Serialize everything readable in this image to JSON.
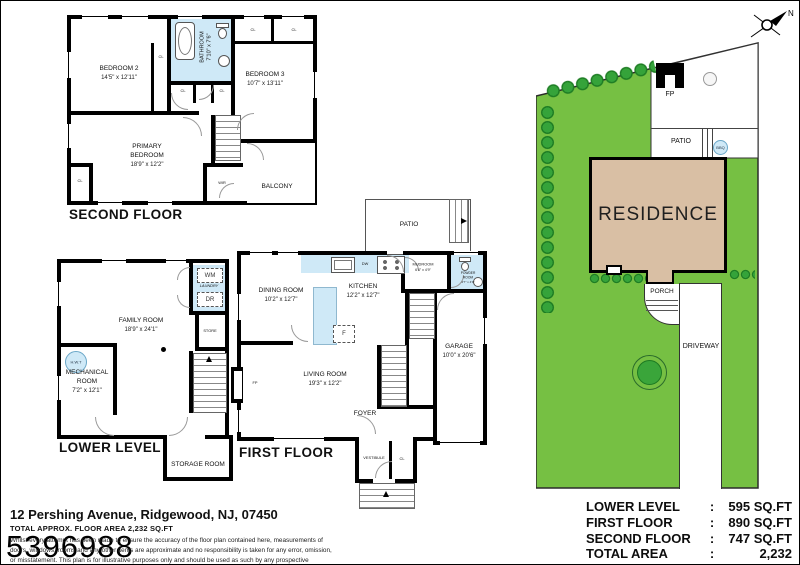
{
  "compass": {
    "n_label": "N"
  },
  "watermark": "5396988",
  "labels": {
    "cl": "CL",
    "wir": "WIR",
    "fp": "FP",
    "dw": "DW",
    "f": "F",
    "wm": "WM",
    "dr": "DR",
    "laundry": "LAUNDRY",
    "hwt": "H.W.T",
    "store": "STORE",
    "bbq": "BBQ",
    "patio": "PATIO"
  },
  "second_floor": {
    "title": "SECOND FLOOR",
    "bedroom2": {
      "name": "BEDROOM 2",
      "dims": "14'5\" x 12'11\""
    },
    "bathroom": {
      "name": "BATHROOM",
      "dims": "7'10\" x 7'6\""
    },
    "bedroom3": {
      "name": "BEDROOM 3",
      "dims": "10'7\" x 13'11\""
    },
    "primary_bedroom": {
      "name": "PRIMARY BEDROOM",
      "dims": "18'9\" x 12'2\""
    },
    "balcony": "BALCONY"
  },
  "lower_level": {
    "title": "LOWER LEVEL",
    "family_room": {
      "name": "FAMILY ROOM",
      "dims": "18'9\" x 24'1\""
    },
    "mechanical_room": {
      "name": "MECHANICAL ROOM",
      "dims": "7'2\" x 12'1\""
    },
    "storage_room": "STORAGE ROOM"
  },
  "first_floor": {
    "title": "FIRST FLOOR",
    "dining_room": {
      "name": "DINING ROOM",
      "dims": "10'2\" x 12'7\""
    },
    "kitchen": {
      "name": "KITCHEN",
      "dims": "12'2\" x 12'7\""
    },
    "mudroom": {
      "name": "MUDROOM",
      "dims": "6'4\" x 4'9\""
    },
    "powder_room": {
      "name": "POWDER ROOM",
      "dims": "2'7\" x 4'9\""
    },
    "garage": {
      "name": "GARAGE",
      "dims": "10'0\" x 20'6\""
    },
    "living_room": {
      "name": "LIVING ROOM",
      "dims": "19'3\" x 12'2\""
    },
    "foyer": "FOYER",
    "vestibule": "VESTIBULE"
  },
  "site_plan": {
    "residence": "RESIDENCE",
    "porch": "PORCH",
    "driveway": "DRIVEWAY"
  },
  "footer": {
    "address": "12 Pershing Avenue, Ridgewood, NJ, 07450",
    "area_line": "TOTAL APPROX. FLOOR AREA 2,232 SQ.FT",
    "disclaimer": "Whilst every attempt has been made to ensure the accuracy of the floor plan contained here, measurements of doors, windows, rooms and any other items are approximate and no responsibility is taken for any error, omission, or misstatement. This plan is for illustrative purposes only and should be used as such by any prospective purchaser."
  },
  "area_table": {
    "colon": ":",
    "rows": [
      {
        "label": "LOWER LEVEL",
        "value": "595 SQ.FT"
      },
      {
        "label": "FIRST FLOOR",
        "value": "890 SQ.FT"
      },
      {
        "label": "SECOND FLOOR",
        "value": "747 SQ.FT"
      },
      {
        "label": "TOTAL AREA",
        "value": "2,232 SQ.FT"
      }
    ]
  },
  "colors": {
    "lawn": "#76c043",
    "tree": "#35a33a",
    "residence_fill": "#d9bfa4",
    "fixture_blue": "#cfe9f7",
    "wall": "#000000"
  }
}
